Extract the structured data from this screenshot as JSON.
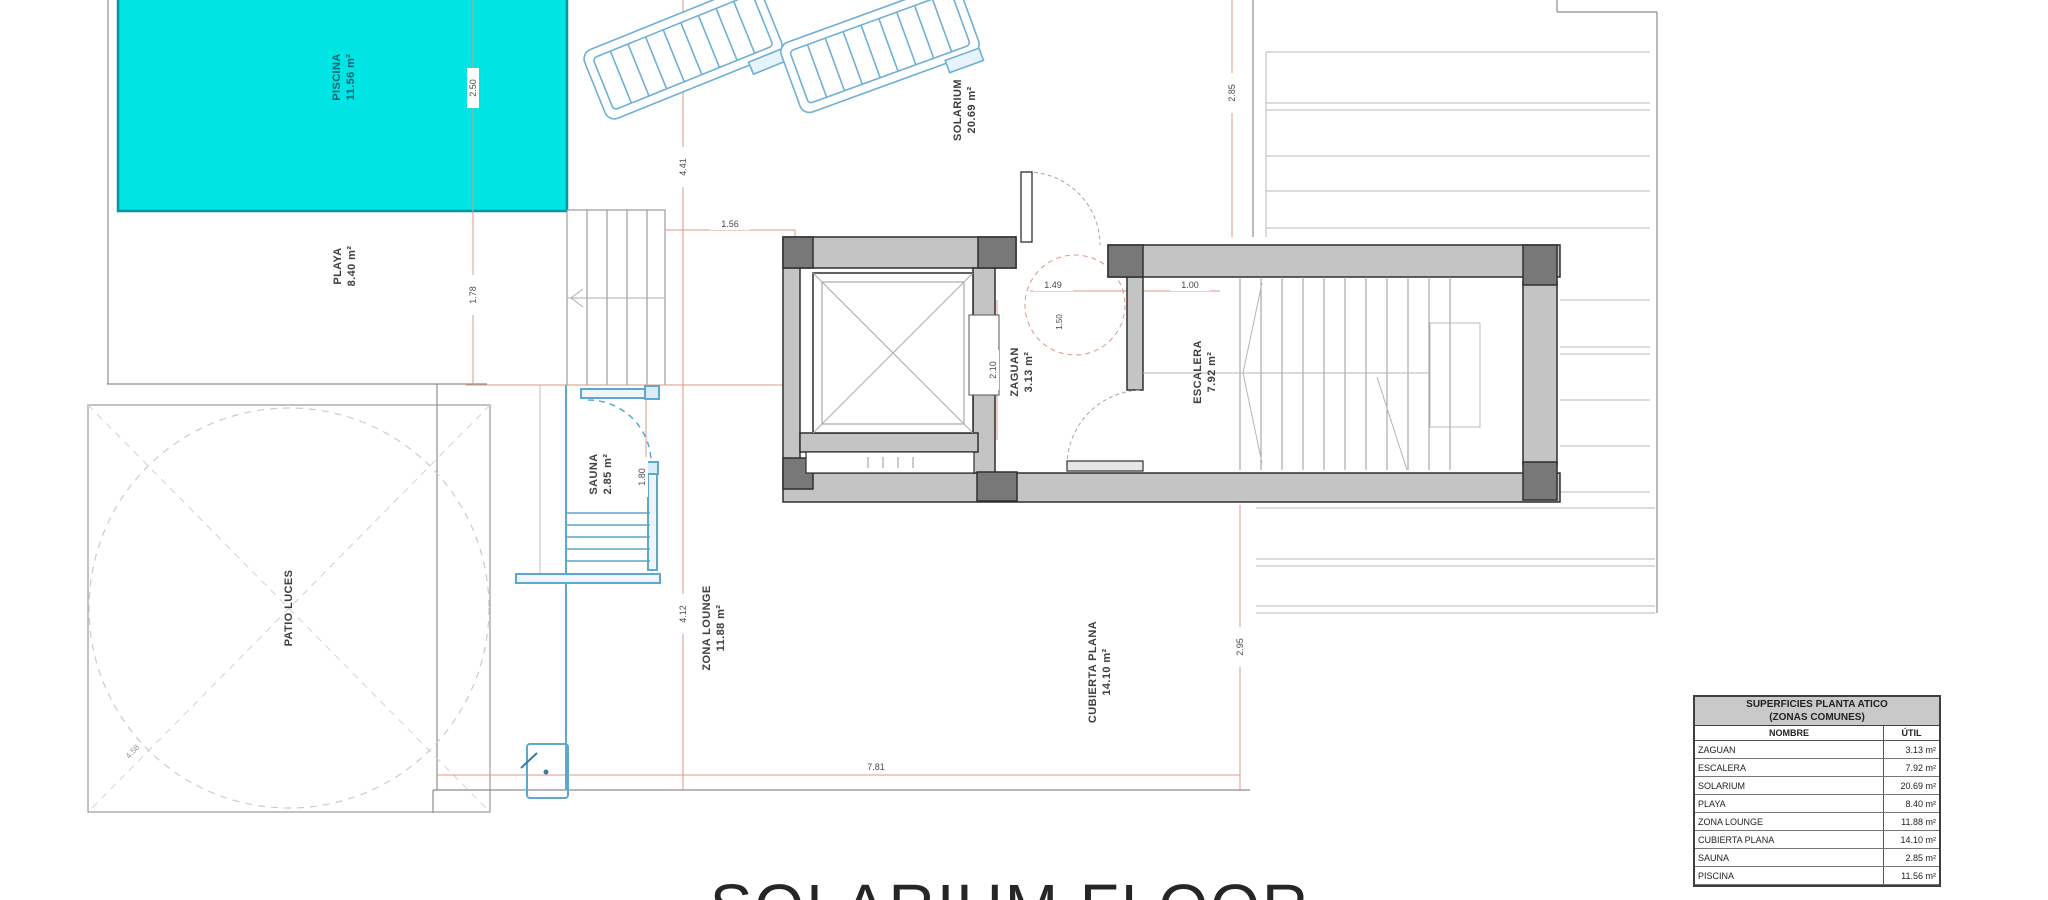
{
  "plan_title": "SOLARIUM FLOOR",
  "rooms": {
    "piscina": {
      "name": "PISCINA",
      "area": "11.56 m²"
    },
    "playa": {
      "name": "PLAYA",
      "area": "8.40 m²"
    },
    "patio_luces": {
      "name": "PATIO LUCES"
    },
    "sauna": {
      "name": "SAUNA",
      "area": "2.85 m²"
    },
    "zona_lounge": {
      "name": "ZONA LOUNGE",
      "area": "11.88 m²"
    },
    "solarium": {
      "name": "SOLARIUM",
      "area": "20.69 m²"
    },
    "zaguan": {
      "name": "ZAGUAN",
      "area": "3.13 m²"
    },
    "escalera": {
      "name": "ESCALERA",
      "area": "7.92 m²"
    },
    "cubierta_plana": {
      "name": "CUBIERTA PLANA",
      "area": "14.10 m²"
    }
  },
  "dimensions": {
    "pool_depth": "2.50",
    "playa_depth": "1.78",
    "solarium_height": "4.41",
    "solarium_width": "1.56",
    "terrace_top": "2.85",
    "zaguan_width": "2.10",
    "zaguan_clear": "1.49",
    "stair_entry": "1.00",
    "turning_circle": "1.50",
    "sauna_width": "1.80",
    "zona_lounge_height": "4.12",
    "cubierta_height": "2.95",
    "terrace_width": "7.81",
    "patio_diagonal": "4.58"
  },
  "legend_table": {
    "title_line1": "SUPERFICIES PLANTA ATICO",
    "title_line2": "(ZONAS COMUNES)",
    "col_nombre": "NOMBRE",
    "col_util": "ÚTIL",
    "rows": [
      {
        "nombre": "ZAGUAN",
        "util": "3.13 m²"
      },
      {
        "nombre": "ESCALERA",
        "util": "7.92 m²"
      },
      {
        "nombre": "SOLARIUM",
        "util": "20.69 m²"
      },
      {
        "nombre": "PLAYA",
        "util": "8.40 m²"
      },
      {
        "nombre": "ZONA LOUNGE",
        "util": "11.88 m²"
      },
      {
        "nombre": "CUBIERTA PLANA",
        "util": "14.10 m²"
      },
      {
        "nombre": "SAUNA",
        "util": "2.85 m²"
      },
      {
        "nombre": "PISCINA",
        "util": "11.56 m²"
      }
    ]
  },
  "colors": {
    "pool_fill": "#00e4e4",
    "pool_border": "#0796a6",
    "blue_element": "#5ea7cf",
    "dimension_line": "#dd9884",
    "wall_fill": "#c4c4c4",
    "wall_dark": "#787878"
  }
}
